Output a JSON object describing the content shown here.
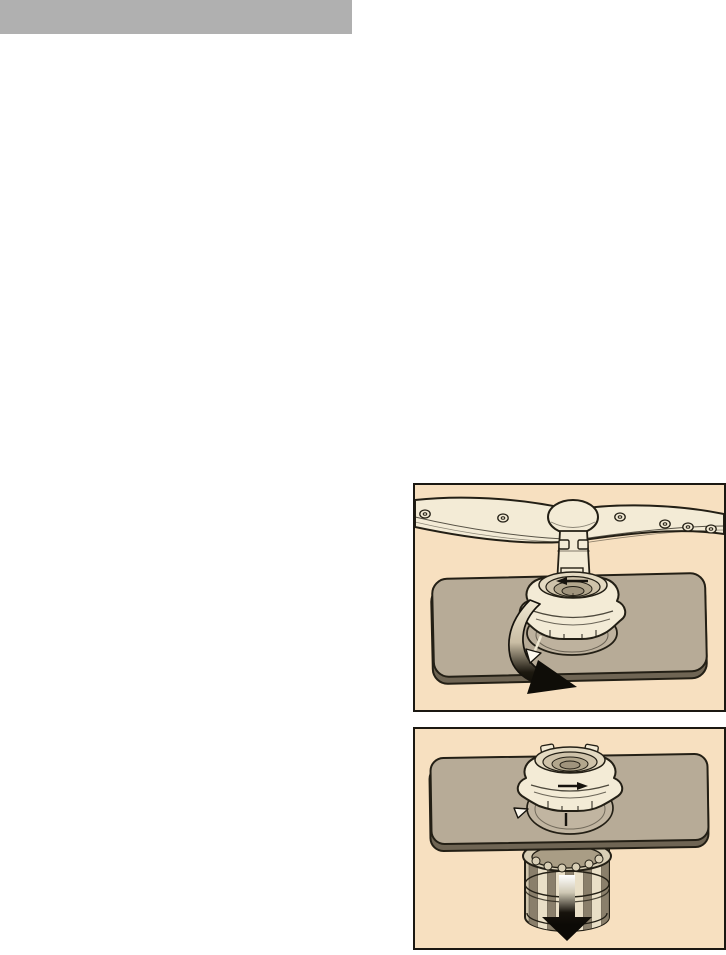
{
  "page": {
    "title": "",
    "visible_text": []
  },
  "header": {
    "label": ""
  },
  "colors": {
    "page_bg": "#ffffff",
    "header_bar": "#b0b0b0",
    "panel_bg": "#f7e0c0",
    "panel_border": "#1b1812",
    "outline": "#231f15",
    "plate": "#b7ab97",
    "plate_edge": "#6f6554",
    "cream_part": "#f3ebd6",
    "part_shade": "#cfc3aa",
    "deep_shade": "#a0947d",
    "arrow_black": "#0f0d08"
  },
  "figures": [
    {
      "name": "figure-turn-locking-ring",
      "description": "Lower spray arm above the filter locking ring on the base plate; curved black arrow shows the ring being turned anti-clockwise to the alignment triangle mark",
      "icons": [
        "rotation-arrow-icon",
        "alignment-triangle-icon",
        "turn-direction-arrow-icon"
      ]
    },
    {
      "name": "figure-remove-filter",
      "description": "Locking ring sitting on the base plate with the cylindrical micro filter released; straight black arrow shows the filter being pulled downwards",
      "icons": [
        "pull-down-arrow-icon",
        "alignment-triangle-icon",
        "turn-direction-arrow-icon"
      ]
    }
  ]
}
